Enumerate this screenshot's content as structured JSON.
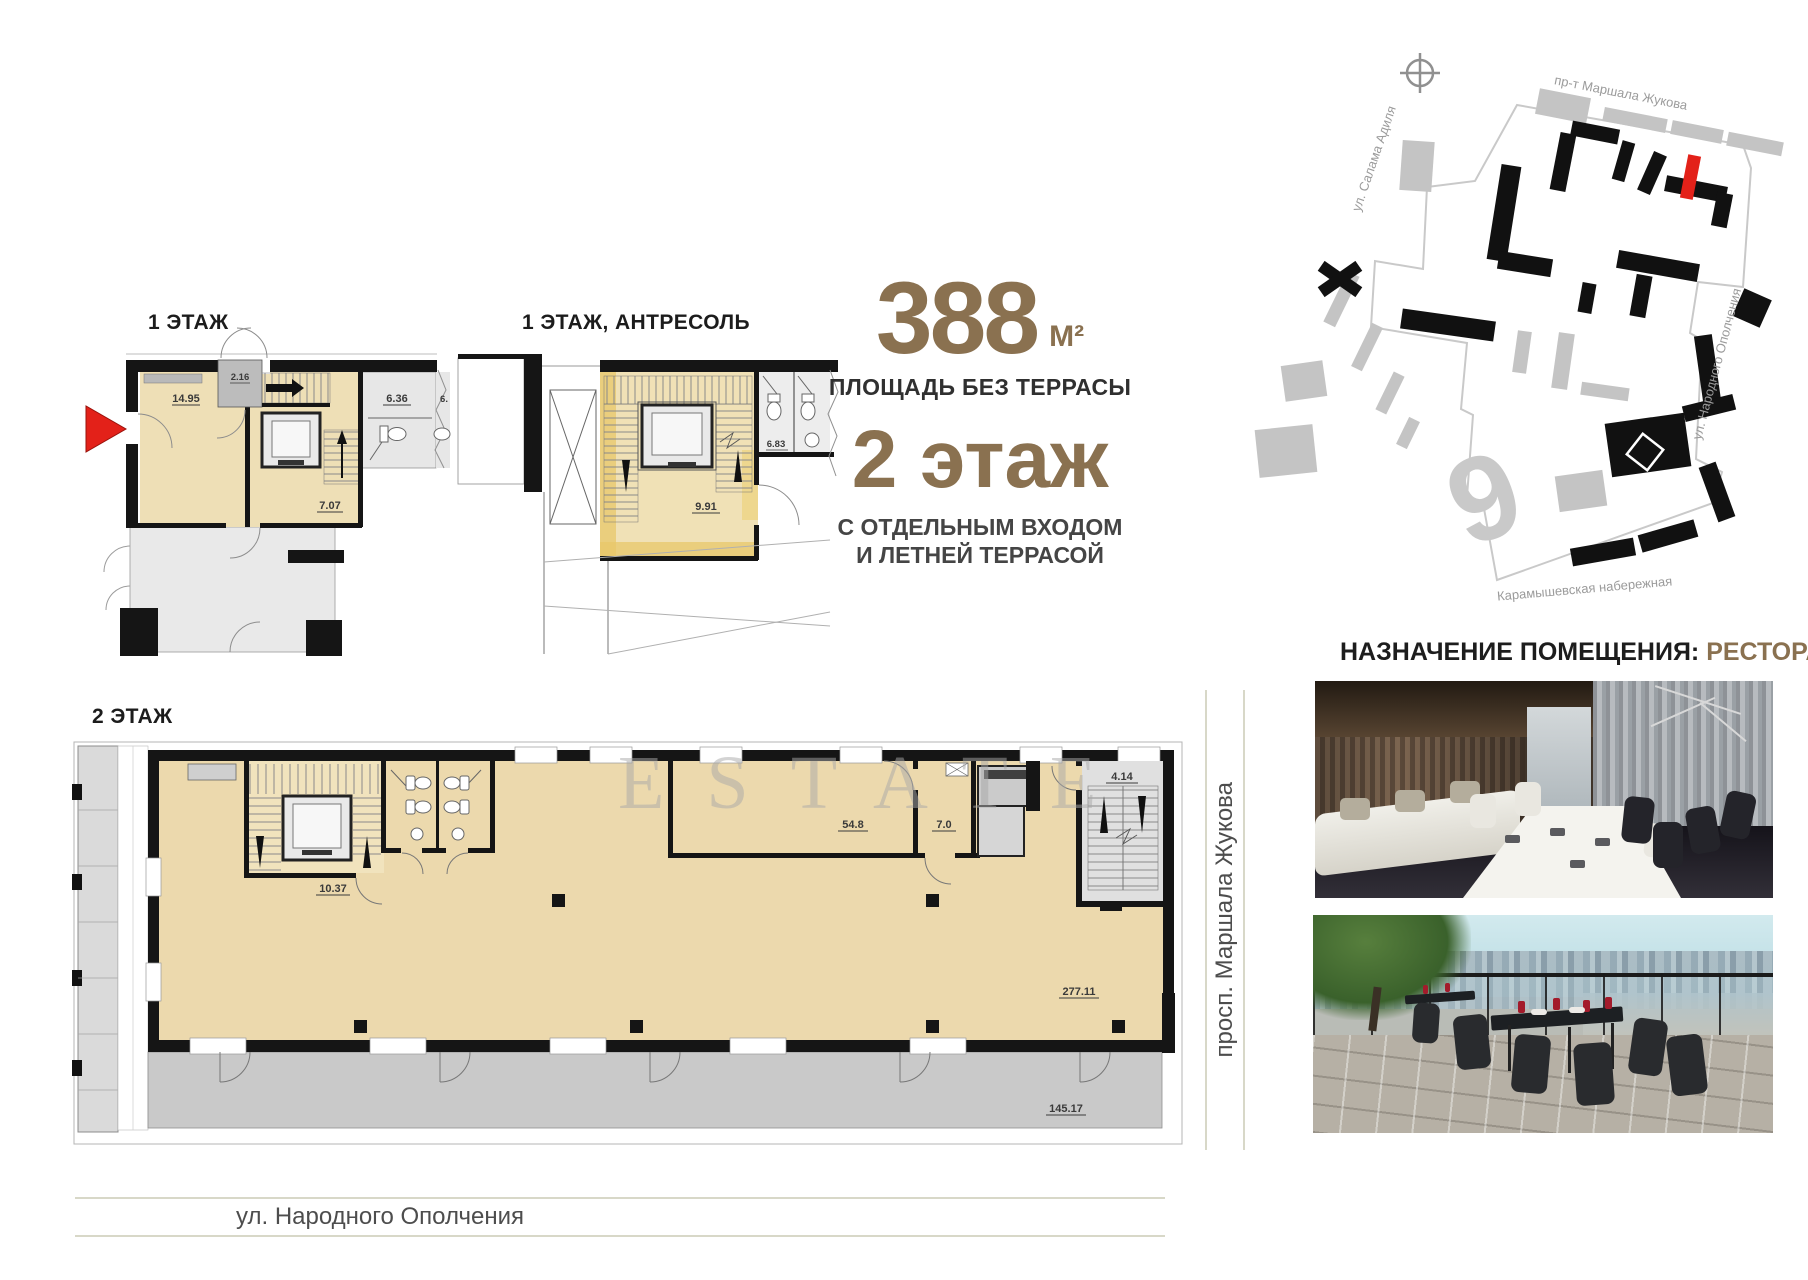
{
  "summary": {
    "area_value": "388",
    "area_unit": "М²",
    "area_caption": "ПЛОЩАДЬ БЕЗ ТЕРРАСЫ",
    "floor_title": "2 этаж",
    "floor_sub_line1": "С ОТДЕЛЬНЫМ ВХОДОМ",
    "floor_sub_line2": "И ЛЕТНЕЙ ТЕРРАСОЙ",
    "accent_color": "#8a7150"
  },
  "purpose": {
    "label": "НАЗНАЧЕНИЕ ПОМЕЩЕНИЯ:",
    "value": "РЕСТОРАН",
    "value_color": "#8a7150"
  },
  "watermark": "ESTATE",
  "plans": {
    "floor1": {
      "title": "1 ЭТАЖ",
      "rooms": {
        "hall": "14.95",
        "vestibule": "2.16",
        "wc": "6.36",
        "wc_partial": "6.",
        "stair_hall": "7.07"
      }
    },
    "mezzanine": {
      "title": "1 ЭТАЖ, АНТРЕСОЛЬ",
      "rooms": {
        "stair_hall": "9.91",
        "wc": "6.83"
      }
    },
    "floor2": {
      "title": "2 ЭТАЖ",
      "rooms": {
        "stair_hall": "10.37",
        "room_a": "54.8",
        "room_b": "7.0",
        "stairwell": "4.14",
        "open_space": "277.11",
        "terrace": "145.17"
      }
    }
  },
  "map": {
    "street_top": "пр-т Маршала Жукова",
    "street_left": "ул. Салама Адиля",
    "street_right": "ул. Народного Ополчения",
    "street_bottom": "Карамышевская набережная",
    "district_digit": "9",
    "marker_color": "#e32119"
  },
  "street_bands": {
    "bottom": "ул. Народного Ополчения",
    "right": "просп. Маршала Жукова"
  }
}
